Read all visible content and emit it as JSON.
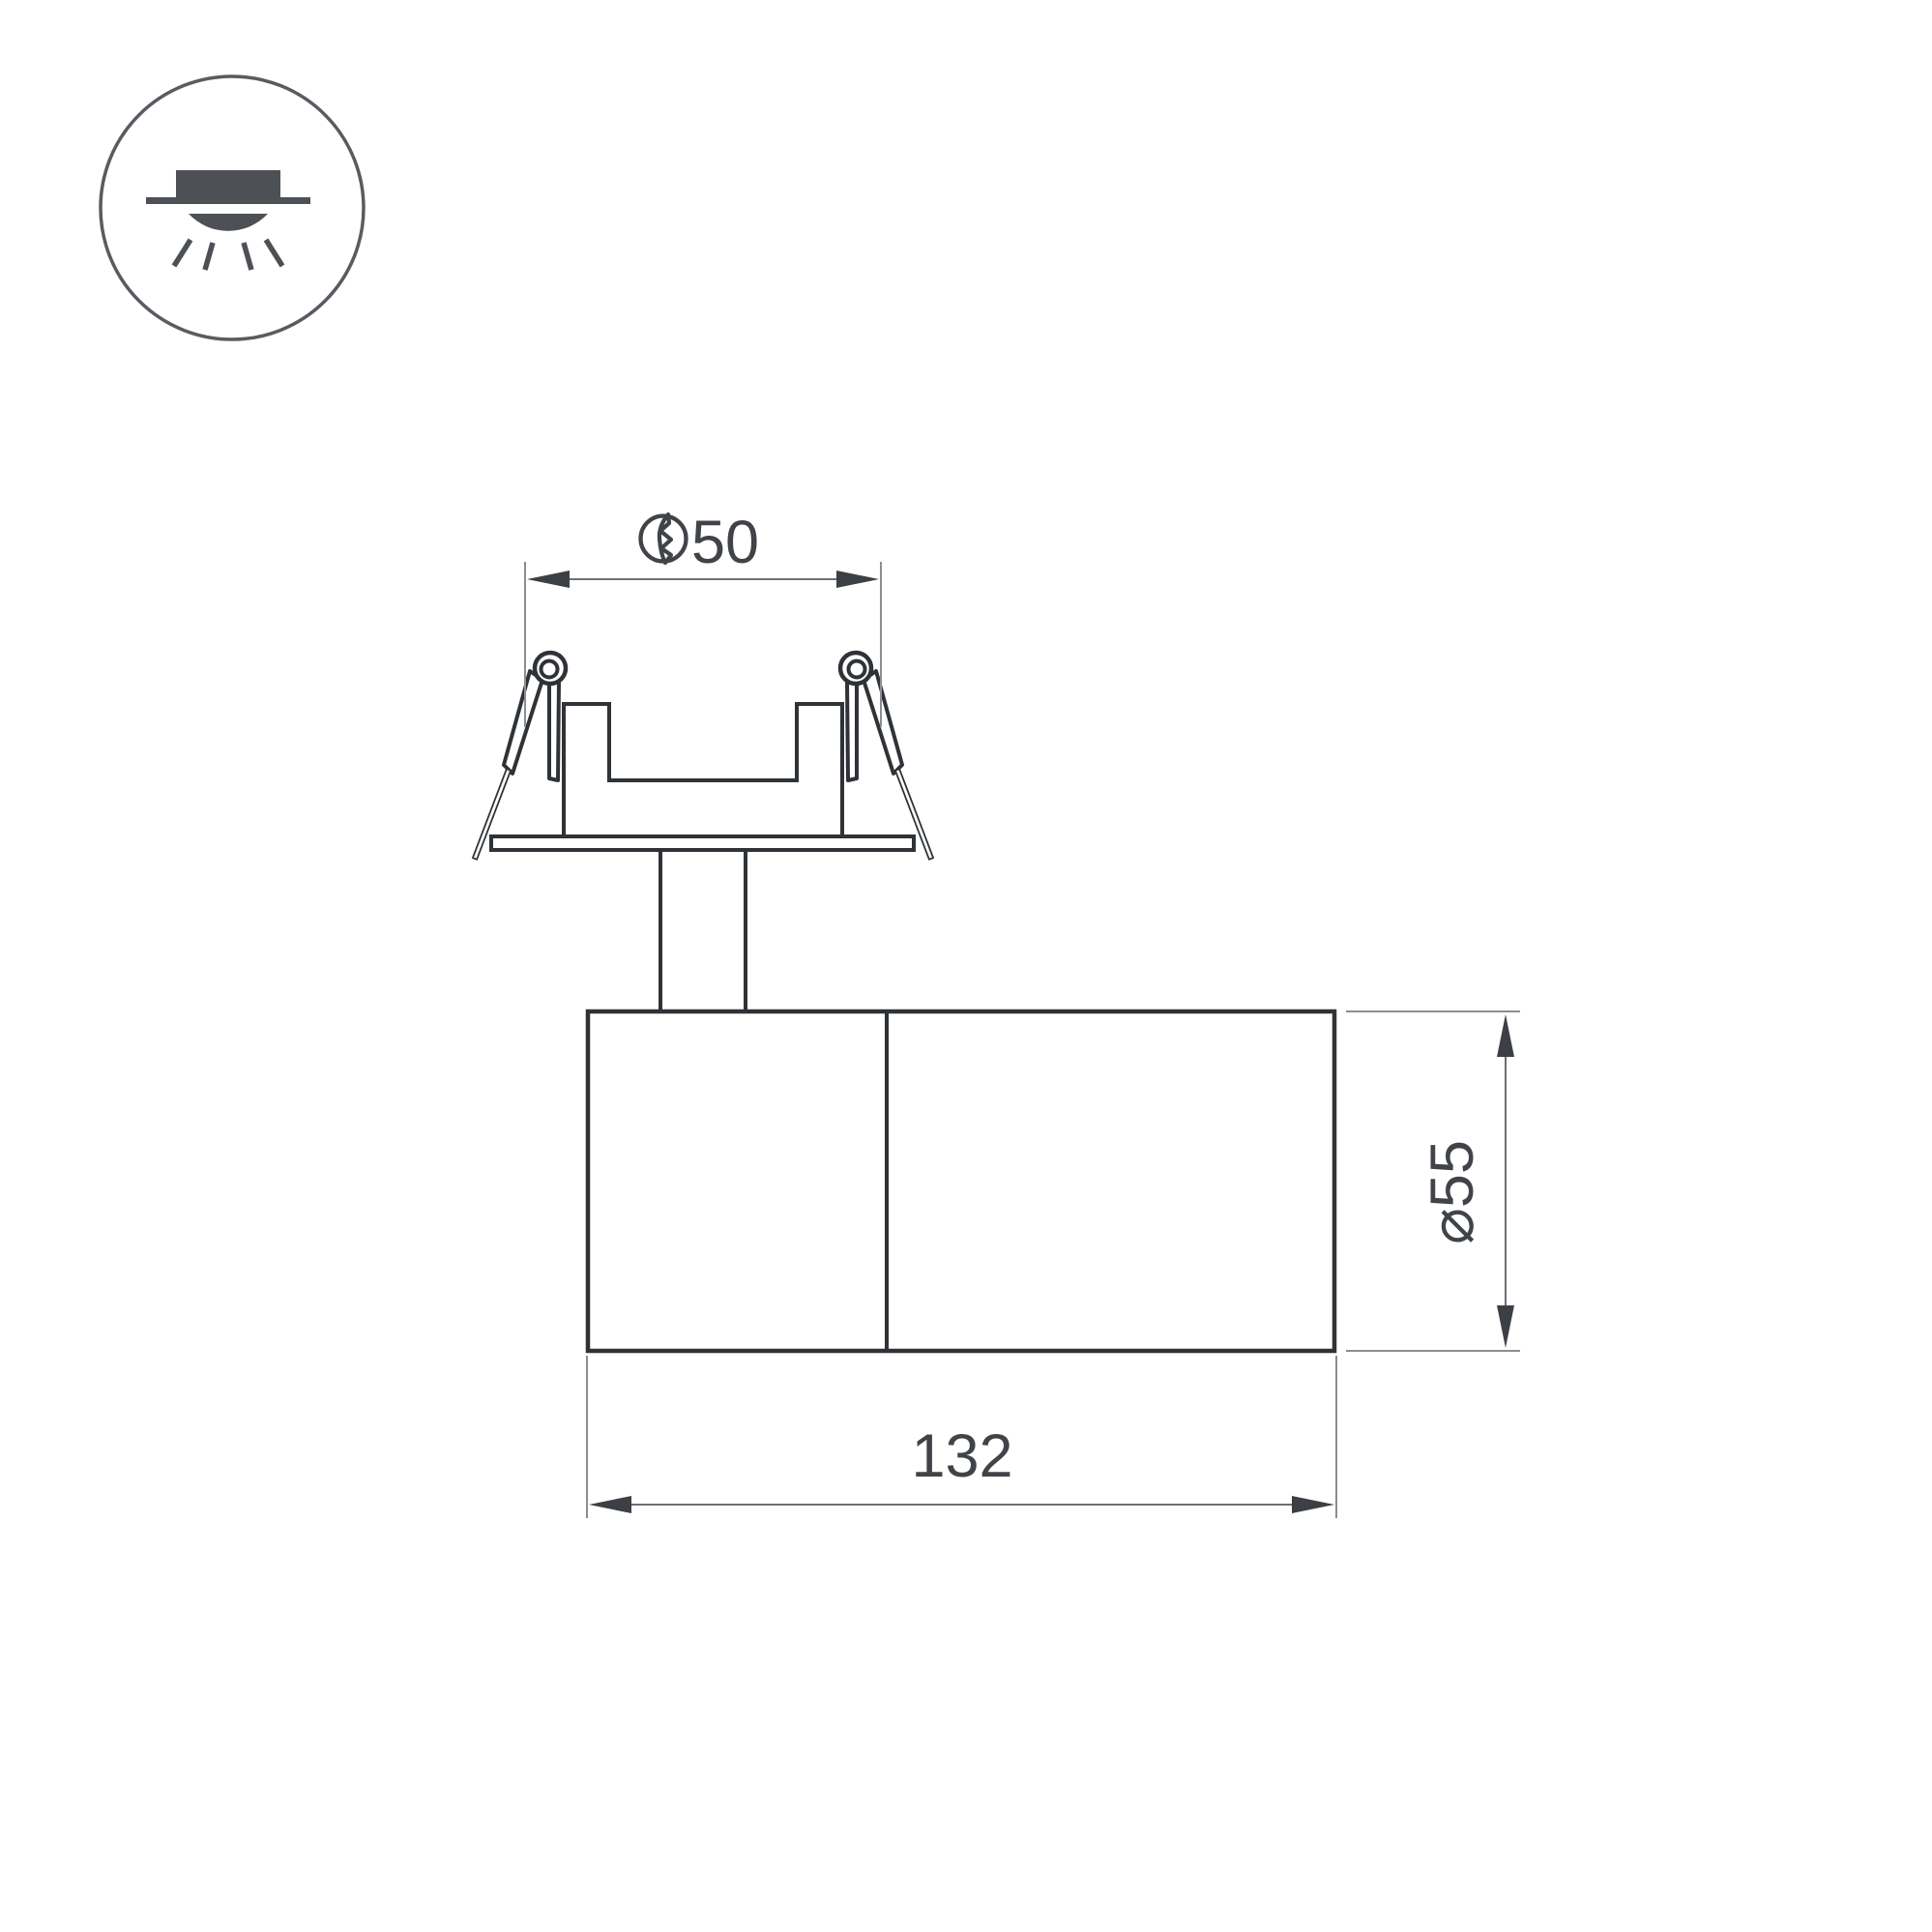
{
  "icons": {
    "mount_type": "recessed-downlight-icon",
    "cutout_hole": "hole-cut-icon"
  },
  "dimensions": {
    "cutout_diameter": {
      "label": "50"
    },
    "body_diameter": {
      "label": "⌀55"
    },
    "body_length": {
      "label": "132"
    }
  },
  "colors": {
    "background": "#ffffff",
    "drawing_line": "#2f3337",
    "dimension_text": "#404448",
    "dimension_line": "#6d7074",
    "extension_line": "#8b8e92",
    "icon": "#4d5156"
  }
}
